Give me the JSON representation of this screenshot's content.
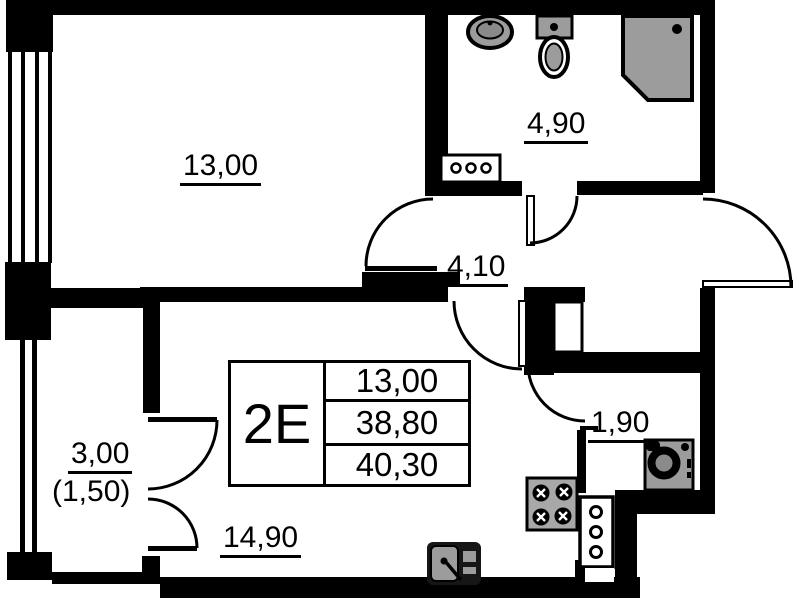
{
  "unit": {
    "label": "2E",
    "rows": [
      "13,00",
      "38,80",
      "40,30"
    ]
  },
  "rooms": {
    "room": "13,00",
    "bathroom": "4,90",
    "hallway": "4,10",
    "storage": "1,90",
    "balcony": "3,00",
    "balcony_reduced": "(1,50)",
    "kitchen_living": "14,90"
  },
  "colors": {
    "wall": "#000000",
    "fixture_gray": "#9c9c9c",
    "background": "#ffffff"
  }
}
